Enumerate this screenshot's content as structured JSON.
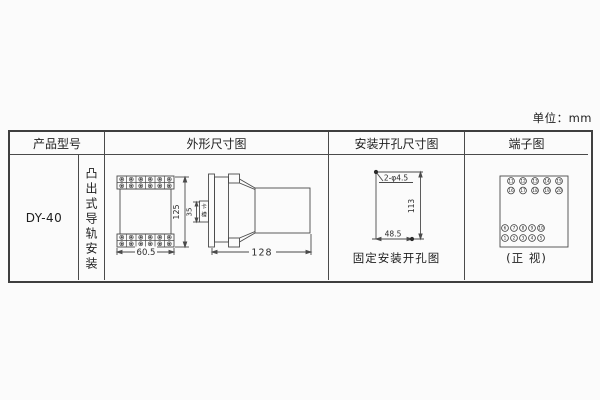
{
  "unit_label": "单位：mm",
  "table": {
    "headers": [
      "产品型号",
      "外形尺寸图",
      "安装开孔尺寸图",
      "端子图"
    ],
    "model": "DY-40",
    "mounting": "凸出式导轨安装"
  },
  "outline": {
    "width_dim": "60.5",
    "height_dim": "125",
    "slot_dim": "35",
    "slot_label": "卡槽",
    "depth_dim": "128"
  },
  "holes": {
    "hole_label": "2-φ4.5",
    "vertical_dim": "113",
    "horizontal_dim": "48.5",
    "caption": "固定安装开孔图"
  },
  "terminals": {
    "top_rows": [
      [
        11,
        12,
        13,
        14,
        15
      ],
      [
        16,
        17,
        18,
        19,
        20
      ]
    ],
    "bottom_rows": [
      [
        6,
        7,
        8,
        9,
        10
      ],
      [
        1,
        2,
        3,
        4,
        5
      ]
    ],
    "caption": "(正 视)"
  }
}
